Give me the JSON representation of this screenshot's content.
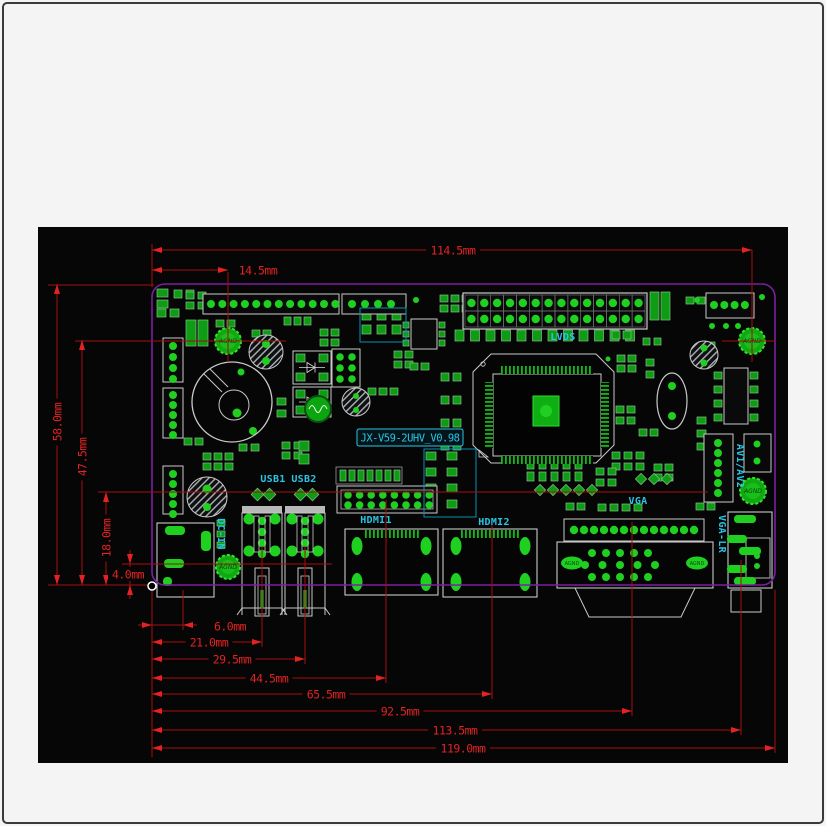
{
  "title_box": {
    "text": "JX-V59-2UHV_V0.98",
    "x": 357,
    "y": 429,
    "w": 106,
    "h": 17
  },
  "colors": {
    "canvas_bg": "#060606",
    "page_bg": "#f4f4f4",
    "dim_line": "#a50d0d",
    "dim_text": "#e32222",
    "board_outline": "#7b1fa2",
    "cyan": "#29c5e6",
    "pad_green": "#0e9c14",
    "bright_green": "#1fd021",
    "outline_gray": "#c9c9c9",
    "hatch_gray": "#aab2b8"
  },
  "canvas": {
    "x": 38,
    "y": 227,
    "w": 750,
    "h": 536
  },
  "board": {
    "x": 152,
    "y": 284,
    "w": 623,
    "h": 301,
    "corner": 13
  },
  "datum": {
    "x": 152,
    "y": 586
  },
  "dims_h": [
    {
      "label": "114.5mm",
      "x1": 152,
      "x2": 752,
      "y": 250,
      "lx": 453,
      "ly": 250
    },
    {
      "label": "14.5mm",
      "x1": 152,
      "x2": 228,
      "y": 270,
      "lx": 258,
      "ly": 270,
      "outside": true
    },
    {
      "label": "6.0mm",
      "x1": 152,
      "x2": 183,
      "y": 625,
      "lx": 230,
      "ly": 626,
      "outside": true,
      "tight": true
    },
    {
      "label": "21.0mm",
      "x1": 152,
      "x2": 262,
      "y": 642,
      "lx": 209,
      "ly": 642
    },
    {
      "label": "29.5mm",
      "x1": 152,
      "x2": 305,
      "y": 659,
      "lx": 232,
      "ly": 659
    },
    {
      "label": "44.5mm",
      "x1": 152,
      "x2": 386,
      "y": 678,
      "lx": 269,
      "ly": 678
    },
    {
      "label": "65.5mm",
      "x1": 152,
      "x2": 492,
      "y": 694,
      "lx": 326,
      "ly": 694
    },
    {
      "label": "92.5mm",
      "x1": 152,
      "x2": 632,
      "y": 711,
      "lx": 400,
      "ly": 711
    },
    {
      "label": "113.5mm",
      "x1": 152,
      "x2": 741,
      "y": 730,
      "lx": 455,
      "ly": 730
    },
    {
      "label": "119.0mm",
      "x1": 152,
      "x2": 775,
      "y": 748,
      "lx": 463,
      "ly": 748
    }
  ],
  "dims_v": [
    {
      "label": "58.0mm",
      "x": 57,
      "y1": 284,
      "y2": 585,
      "ly": 422,
      "rot": true
    },
    {
      "label": "47.5mm",
      "x": 82,
      "y1": 340,
      "y2": 585,
      "ly": 457,
      "rot": true
    },
    {
      "label": "18.0mm",
      "x": 106,
      "y1": 492,
      "y2": 585,
      "ly": 538,
      "rot": true
    },
    {
      "label": "4.0mm",
      "x": 130,
      "y1": 564,
      "y2": 585,
      "ly": 574,
      "lx": 128,
      "tight": true
    }
  ],
  "ext_lines": [
    [
      48,
      285,
      154,
      285
    ],
    [
      75,
      341,
      286,
      341
    ],
    [
      722,
      341,
      776,
      341
    ],
    [
      98,
      492,
      708,
      492
    ],
    [
      122,
      564,
      332,
      564
    ],
    [
      48,
      585,
      150,
      585
    ],
    [
      152,
      244,
      152,
      287
    ],
    [
      152,
      588,
      152,
      757
    ],
    [
      183,
      590,
      183,
      630
    ],
    [
      262,
      546,
      262,
      647
    ],
    [
      305,
      546,
      305,
      664
    ],
    [
      386,
      500,
      386,
      683
    ],
    [
      492,
      522,
      492,
      699
    ],
    [
      632,
      522,
      632,
      716
    ],
    [
      741,
      560,
      741,
      735
    ],
    [
      775,
      590,
      775,
      753
    ],
    [
      752,
      250,
      752,
      362
    ],
    [
      228,
      272,
      228,
      362
    ]
  ],
  "labels": [
    {
      "text": "LVDS",
      "x": 563,
      "y": 337
    },
    {
      "text": "USB1",
      "x": 273,
      "y": 479
    },
    {
      "text": "USB2",
      "x": 304,
      "y": 479
    },
    {
      "text": "HDMI1",
      "x": 376,
      "y": 520
    },
    {
      "text": "HDMI2",
      "x": 494,
      "y": 522
    },
    {
      "text": "VGA",
      "x": 638,
      "y": 501
    },
    {
      "text": "DC-IN",
      "x": 221,
      "y": 534,
      "rot": 90
    },
    {
      "text": "AV1/AV2",
      "x": 740,
      "y": 466,
      "rot": 90
    },
    {
      "text": "VGA-LR",
      "x": 722,
      "y": 534,
      "rot": 90
    }
  ],
  "holes": [
    {
      "x": 228,
      "y": 341,
      "r": 13,
      "label": "AGND"
    },
    {
      "x": 752,
      "y": 341,
      "r": 13,
      "label": "AGND"
    },
    {
      "x": 753,
      "y": 491,
      "r": 13,
      "label": "AGND"
    },
    {
      "x": 228,
      "y": 567,
      "r": 12,
      "label": "AGND"
    }
  ],
  "oval_pads": [
    {
      "x": 572,
      "y": 563,
      "rx": 11,
      "ry": 6.5,
      "label": "AGND"
    },
    {
      "x": 697,
      "y": 563,
      "rx": 11,
      "ry": 6.5,
      "label": "AGND"
    }
  ],
  "hatched_circles": [
    {
      "x": 266,
      "y": 352,
      "r": 17,
      "dots": [
        [
          266,
          344,
          4
        ],
        [
          266,
          361,
          4
        ]
      ]
    },
    {
      "x": 207,
      "y": 497,
      "r": 20,
      "dots": [
        [
          207,
          489,
          4.5
        ],
        [
          207,
          507,
          4
        ]
      ]
    },
    {
      "x": 704,
      "y": 355,
      "r": 14,
      "dots": [
        [
          704,
          348,
          3.5
        ],
        [
          704,
          363,
          3.5
        ]
      ]
    },
    {
      "x": 356,
      "y": 402,
      "r": 14,
      "dots": [
        [
          356,
          396,
          3
        ],
        [
          356,
          410,
          3
        ]
      ]
    }
  ],
  "headers": [
    {
      "x": 203,
      "y": 294,
      "w": 136,
      "h": 20,
      "n": 12,
      "x0": 211,
      "step": 11.3,
      "cy": 304,
      "r": 4
    },
    {
      "x": 342,
      "y": 294,
      "w": 64,
      "h": 20,
      "n": 4,
      "x0": 352,
      "step": 13,
      "cy": 304,
      "r": 4
    },
    {
      "x": 706,
      "y": 293,
      "w": 48,
      "h": 25,
      "n": 4,
      "x0": 714,
      "step": 10.3,
      "cy": 305,
      "r": 4
    },
    {
      "x": 163,
      "y": 338,
      "w": 20,
      "h": 44,
      "n": 4,
      "y0": 346,
      "step": 11,
      "cx": 173,
      "r": 4,
      "vert": true
    },
    {
      "x": 163,
      "y": 388,
      "w": 20,
      "h": 50,
      "n": 5,
      "y0": 395,
      "step": 10,
      "cx": 173,
      "r": 4,
      "vert": true
    },
    {
      "x": 163,
      "y": 466,
      "w": 20,
      "h": 48,
      "n": 5,
      "y0": 474,
      "step": 10,
      "cx": 173,
      "r": 4,
      "vert": true
    },
    {
      "x": 704,
      "y": 434,
      "w": 29,
      "h": 68,
      "n": 6,
      "y0": 443,
      "step": 10,
      "cx": 718,
      "r": 4,
      "vert": true
    },
    {
      "x": 744,
      "y": 434,
      "w": 27,
      "h": 38,
      "n": 2,
      "y0": 444,
      "step": 17,
      "cx": 757,
      "r": 3.5,
      "vert": true
    }
  ],
  "lvds_conn": {
    "x": 463,
    "y": 293,
    "w": 184,
    "h": 36,
    "cols": 14,
    "rows": 2
  },
  "hdmi1_header": {
    "x": 337,
    "y": 486,
    "w": 100,
    "h": 27,
    "cols": 8,
    "x0": 348,
    "step": 11.6,
    "ry": [
      495,
      505
    ],
    "r": 3.8
  },
  "row_header": {
    "x": 336,
    "y": 467,
    "w": 66,
    "h": 17,
    "n": 7
  },
  "chip": {
    "x": 473,
    "y": 354,
    "w": 141,
    "h": 109,
    "cut": 18,
    "body": {
      "x": 493,
      "y": 374,
      "w": 108,
      "h": 82
    },
    "pad": {
      "x": 533,
      "y": 396,
      "w": 26,
      "h": 30
    }
  },
  "coil": {
    "x": 232,
    "y": 402,
    "r": 40,
    "ir": 15
  },
  "crystal": {
    "x": 672,
    "y": 401,
    "rx": 15,
    "ry": 28
  },
  "sop8": {
    "x": 724,
    "y": 368,
    "w": 24,
    "h": 56
  },
  "soic8": {
    "x": 411,
    "y": 319,
    "w": 26,
    "h": 30
  },
  "six_dot": {
    "x": 332,
    "y": 349,
    "w": 28,
    "h": 38
  },
  "power_blocks": [
    {
      "x": 293,
      "y": 351,
      "w": 38,
      "h": 33
    },
    {
      "x": 293,
      "y": 387,
      "w": 38,
      "h": 30
    }
  ],
  "toroid": {
    "x": 318,
    "y": 409,
    "r": 13
  },
  "tall_caps": [
    [
      186,
      320,
      10,
      26
    ],
    [
      198,
      320,
      10,
      26
    ],
    [
      650,
      292,
      9,
      28
    ],
    [
      661,
      292,
      9,
      28
    ]
  ],
  "usb": {
    "centers": [
      262,
      305
    ],
    "cap_y": 506,
    "cap_w": 40,
    "body_y": 513,
    "body_h": 95,
    "body_w": 40
  },
  "hdmi_shells": [
    {
      "x": 345,
      "y": 529,
      "w": 93,
      "h": 66,
      "ovals": [
        [
          357,
          546
        ],
        [
          426,
          546
        ],
        [
          357,
          582
        ],
        [
          426,
          582
        ]
      ]
    },
    {
      "x": 443,
      "y": 529,
      "w": 94,
      "h": 68,
      "ovals": [
        [
          456,
          546
        ],
        [
          525,
          546
        ],
        [
          456,
          582
        ],
        [
          525,
          582
        ]
      ]
    }
  ],
  "vga": {
    "row": {
      "x": 564,
      "y": 519,
      "w": 140,
      "h": 22,
      "n": 13,
      "x0": 574,
      "step": 10,
      "cy": 530
    },
    "body": {
      "x": 557,
      "y": 542,
      "w": 156,
      "h": 46
    },
    "shell": [
      [
        575,
        588
      ],
      [
        695,
        588
      ],
      [
        681,
        617
      ],
      [
        589,
        617
      ]
    ]
  },
  "vgalr": {
    "x": 728,
    "y": 512,
    "w": 44,
    "h": 76,
    "inner": [
      746,
      538,
      24,
      40
    ],
    "bars": [
      [
        734,
        515,
        22,
        8
      ],
      [
        727,
        535,
        20,
        8
      ],
      [
        739,
        547,
        22,
        8
      ],
      [
        727,
        565,
        20,
        8
      ],
      [
        734,
        577,
        22,
        8
      ]
    ],
    "dots": [
      [
        757,
        556
      ],
      [
        757,
        566
      ]
    ],
    "below": [
      731,
      590,
      30,
      22
    ]
  },
  "dcin": {
    "x": 157,
    "y": 523,
    "w": 57,
    "h": 74,
    "pads": [
      [
        165,
        526,
        20,
        9
      ],
      [
        201,
        531,
        10,
        20
      ],
      [
        164,
        559,
        20,
        9
      ],
      [
        163,
        577,
        9,
        9
      ]
    ]
  },
  "teal_boxes": [
    [
      360,
      308,
      46,
      34
    ],
    [
      424,
      449,
      52,
      68
    ]
  ],
  "clusters": [
    {
      "x": 157,
      "y": 289,
      "c": 1,
      "r": 2,
      "gx": 0,
      "gy": 11,
      "w": 11,
      "h": 8
    },
    {
      "x": 174,
      "y": 290,
      "c": 2,
      "r": 1,
      "gx": 12,
      "gy": 0,
      "w": 8,
      "h": 8
    },
    {
      "x": 157,
      "y": 309,
      "c": 2,
      "r": 1,
      "gx": 13,
      "gy": 0,
      "w": 9,
      "h": 8
    },
    {
      "x": 186,
      "y": 292,
      "c": 2,
      "r": 2,
      "gx": 12,
      "gy": 10,
      "w": 8,
      "h": 7
    },
    {
      "x": 216,
      "y": 320,
      "c": 2,
      "r": 1,
      "gx": 11,
      "gy": 0,
      "w": 8,
      "h": 7
    },
    {
      "x": 252,
      "y": 330,
      "c": 2,
      "r": 1,
      "gx": 11,
      "gy": 0,
      "w": 8,
      "h": 7
    },
    {
      "x": 284,
      "y": 317,
      "c": 3,
      "r": 1,
      "gx": 10,
      "gy": 0,
      "w": 7,
      "h": 8
    },
    {
      "x": 320,
      "y": 329,
      "c": 2,
      "r": 2,
      "gx": 11,
      "gy": 10,
      "w": 8,
      "h": 7
    },
    {
      "x": 362,
      "y": 311,
      "c": 3,
      "r": 2,
      "gx": 15,
      "gy": 14,
      "w": 9,
      "h": 9
    },
    {
      "x": 440,
      "y": 295,
      "c": 3,
      "r": 2,
      "gx": 11,
      "gy": 10,
      "w": 8,
      "h": 7
    },
    {
      "x": 455,
      "y": 330,
      "c": 12,
      "r": 1,
      "gx": 15.5,
      "gy": 0,
      "w": 9,
      "h": 11
    },
    {
      "x": 612,
      "y": 331,
      "c": 2,
      "r": 1,
      "gx": 11,
      "gy": 0,
      "w": 8,
      "h": 8
    },
    {
      "x": 686,
      "y": 297,
      "c": 2,
      "r": 1,
      "gx": 11,
      "gy": 0,
      "w": 8,
      "h": 7
    },
    {
      "x": 617,
      "y": 355,
      "c": 2,
      "r": 2,
      "gx": 11,
      "gy": 10,
      "w": 8,
      "h": 7
    },
    {
      "x": 646,
      "y": 359,
      "c": 1,
      "r": 2,
      "gx": 0,
      "gy": 12,
      "w": 8,
      "h": 7
    },
    {
      "x": 643,
      "y": 338,
      "c": 2,
      "r": 1,
      "gx": 11,
      "gy": 0,
      "w": 7,
      "h": 7
    },
    {
      "x": 441,
      "y": 373,
      "c": 2,
      "r": 4,
      "gx": 12,
      "gy": 23,
      "w": 8,
      "h": 8
    },
    {
      "x": 616,
      "y": 406,
      "c": 2,
      "r": 2,
      "gx": 11,
      "gy": 11,
      "w": 8,
      "h": 7
    },
    {
      "x": 639,
      "y": 429,
      "c": 2,
      "r": 1,
      "gx": 11,
      "gy": 0,
      "w": 8,
      "h": 7
    },
    {
      "x": 612,
      "y": 452,
      "c": 3,
      "r": 2,
      "gx": 12,
      "gy": 11,
      "w": 8,
      "h": 7
    },
    {
      "x": 654,
      "y": 464,
      "c": 2,
      "r": 2,
      "gx": 11,
      "gy": 10,
      "w": 8,
      "h": 7
    },
    {
      "x": 697,
      "y": 417,
      "c": 1,
      "r": 3,
      "gx": 0,
      "gy": 13,
      "w": 9,
      "h": 7
    },
    {
      "x": 527,
      "y": 460,
      "c": 5,
      "r": 2,
      "gx": 12,
      "gy": 12,
      "w": 7,
      "h": 9
    },
    {
      "x": 536,
      "y": 486,
      "c": 5,
      "r": 1,
      "gx": 13,
      "gy": 0,
      "w": 8,
      "h": 8,
      "rot": 45
    },
    {
      "x": 596,
      "y": 468,
      "c": 2,
      "r": 2,
      "gx": 12,
      "gy": 11,
      "w": 8,
      "h": 7
    },
    {
      "x": 598,
      "y": 504,
      "c": 4,
      "r": 1,
      "gx": 12,
      "gy": 0,
      "w": 8,
      "h": 7
    },
    {
      "x": 426,
      "y": 452,
      "c": 2,
      "r": 4,
      "gx": 21,
      "gy": 16,
      "w": 10,
      "h": 8
    },
    {
      "x": 282,
      "y": 442,
      "c": 2,
      "r": 2,
      "gx": 12,
      "gy": 10,
      "w": 8,
      "h": 7
    },
    {
      "x": 239,
      "y": 444,
      "c": 2,
      "r": 1,
      "gx": 12,
      "gy": 0,
      "w": 8,
      "h": 7
    },
    {
      "x": 299,
      "y": 441,
      "c": 1,
      "r": 2,
      "gx": 0,
      "gy": 13,
      "w": 10,
      "h": 10
    },
    {
      "x": 217,
      "y": 520,
      "c": 1,
      "r": 3,
      "gx": 0,
      "gy": 11,
      "w": 8,
      "h": 6
    },
    {
      "x": 184,
      "y": 438,
      "c": 2,
      "r": 1,
      "gx": 11,
      "gy": 0,
      "w": 8,
      "h": 7
    },
    {
      "x": 203,
      "y": 453,
      "c": 3,
      "r": 2,
      "gx": 11,
      "gy": 10,
      "w": 8,
      "h": 7
    },
    {
      "x": 277,
      "y": 398,
      "c": 1,
      "r": 2,
      "gx": 0,
      "gy": 12,
      "w": 9,
      "h": 7
    },
    {
      "x": 394,
      "y": 351,
      "c": 2,
      "r": 2,
      "gx": 11,
      "gy": 10,
      "w": 8,
      "h": 7
    },
    {
      "x": 368,
      "y": 388,
      "c": 3,
      "r": 1,
      "gx": 11,
      "gy": 0,
      "w": 8,
      "h": 7
    },
    {
      "x": 410,
      "y": 363,
      "c": 2,
      "r": 1,
      "gx": 11,
      "gy": 0,
      "w": 8,
      "h": 7
    },
    {
      "x": 253,
      "y": 490,
      "c": 2,
      "r": 1,
      "gx": 12,
      "gy": 0,
      "w": 9,
      "h": 9,
      "rot": 45
    },
    {
      "x": 296,
      "y": 490,
      "c": 2,
      "r": 1,
      "gx": 12,
      "gy": 0,
      "w": 9,
      "h": 9,
      "rot": 45
    },
    {
      "x": 637,
      "y": 475,
      "c": 3,
      "r": 1,
      "gx": 13,
      "gy": 0,
      "w": 8,
      "h": 8,
      "rot": 45
    },
    {
      "x": 696,
      "y": 503,
      "c": 2,
      "r": 1,
      "gx": 11,
      "gy": 0,
      "w": 8,
      "h": 7
    },
    {
      "x": 566,
      "y": 503,
      "c": 2,
      "r": 1,
      "gx": 11,
      "gy": 0,
      "w": 8,
      "h": 7
    },
    {
      "x": 708,
      "y": 342,
      "c": 1,
      "r": 2,
      "gx": 0,
      "gy": 11,
      "w": 7,
      "h": 7
    },
    {
      "x": 530,
      "y": 432,
      "c": 2,
      "r": 1,
      "gx": 11,
      "gy": 0,
      "w": 8,
      "h": 7
    }
  ],
  "dots": [
    [
      697,
      300,
      3
    ],
    [
      762,
      297,
      3
    ],
    [
      372,
      302,
      3
    ],
    [
      416,
      300,
      3
    ],
    [
      237,
      413,
      4.5
    ],
    [
      253,
      431,
      4
    ],
    [
      241,
      372,
      3.5
    ],
    [
      499,
      359,
      2.5
    ],
    [
      608,
      359,
      2.5
    ],
    [
      712,
      326,
      3
    ],
    [
      726,
      326,
      3
    ],
    [
      738,
      326,
      3
    ]
  ]
}
